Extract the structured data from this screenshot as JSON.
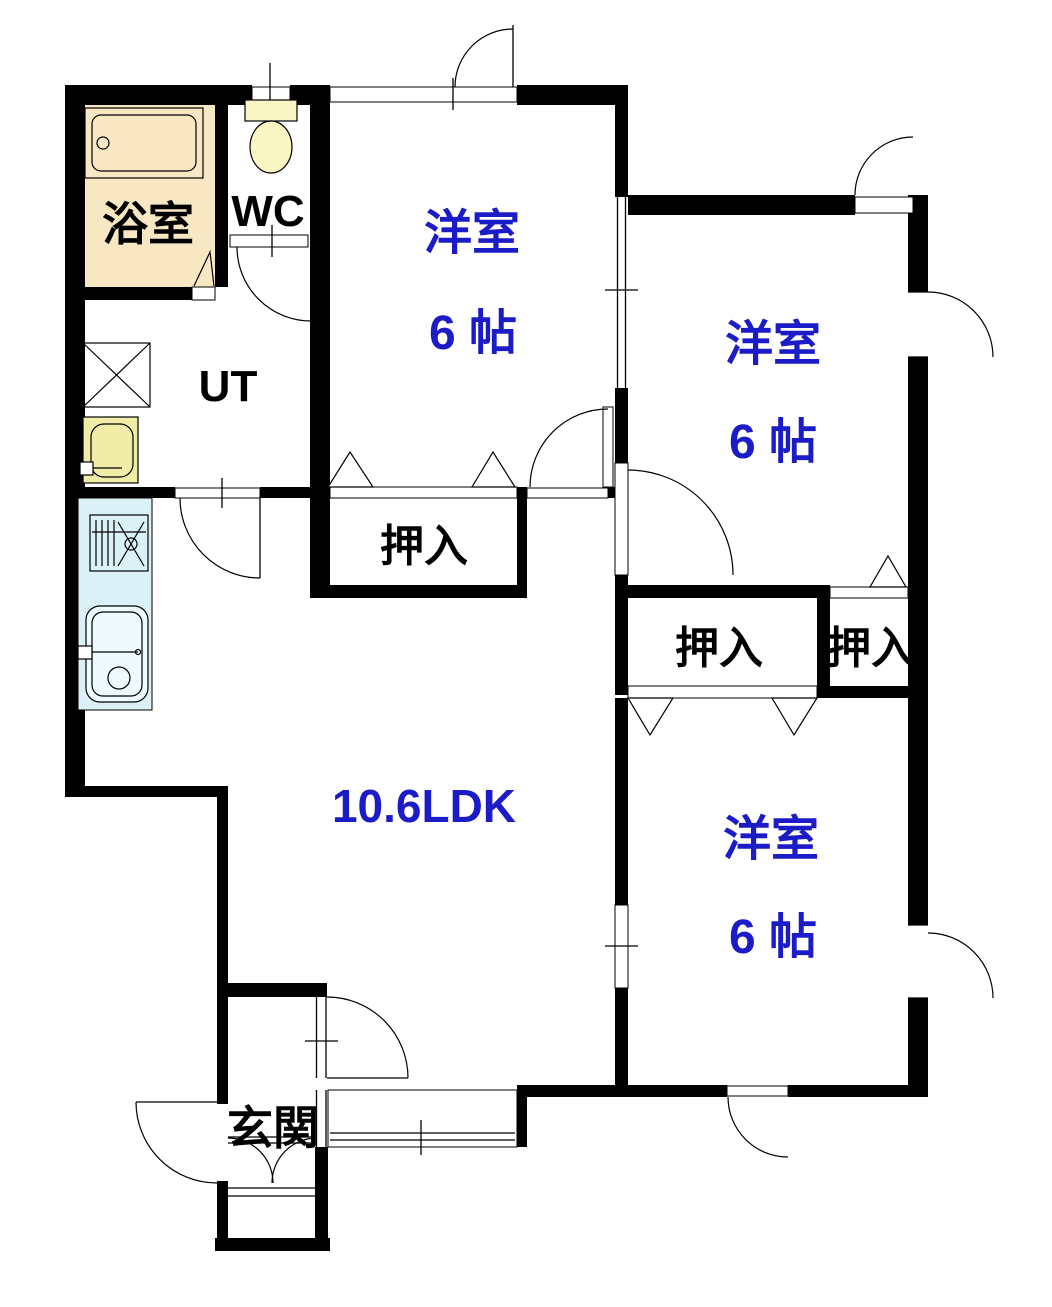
{
  "plan_title": "2LDK apartment floor plan",
  "colors": {
    "wall": "#000000",
    "room_label_blue": "#1b1bc8",
    "bath_floor": "#f8e7c3",
    "fixture_yellow": "#faf6c4",
    "basin_yellow": "#f2eda6",
    "counter_blue": "#daf1f8",
    "sink_blue": "#eefafd",
    "background": "#ffffff"
  },
  "rooms": {
    "bathroom": {
      "label": "浴室"
    },
    "toilet": {
      "label": "WC"
    },
    "utility": {
      "label": "UT"
    },
    "western_room_top": {
      "label": "洋室",
      "size": "6 帖"
    },
    "western_room_right": {
      "label": "洋室",
      "size": "6 帖"
    },
    "western_room_bottom": {
      "label": "洋室",
      "size": "6 帖"
    },
    "ldk": {
      "label": "10.6LDK"
    },
    "closet_top": {
      "label": "押入"
    },
    "closet_mid_left": {
      "label": "押入"
    },
    "closet_mid_right": {
      "label": "押入"
    },
    "entrance": {
      "label": "玄関"
    }
  },
  "fixtures": [
    "bathtub-icon",
    "toilet-icon",
    "washing-machine-icon",
    "washbasin-icon",
    "gas-stove-icon",
    "kitchen-sink-icon"
  ]
}
